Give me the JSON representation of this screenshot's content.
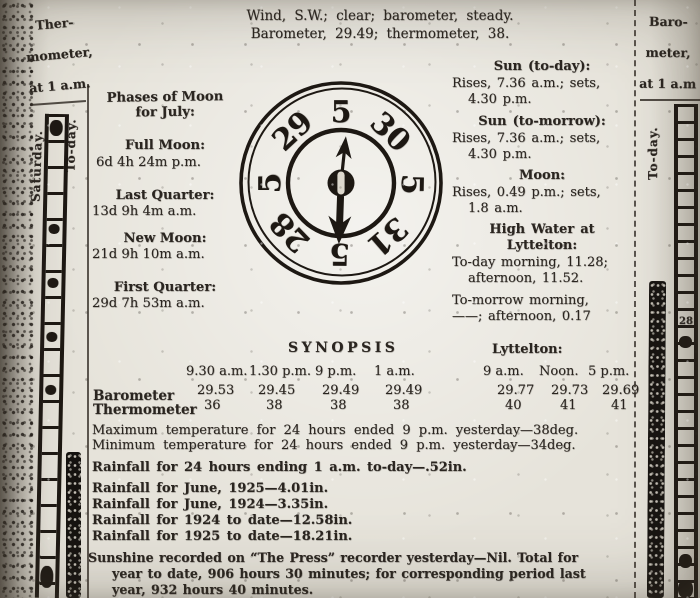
{
  "header": {
    "line1": "Wind, S.W.; clear; barometer, steady.",
    "line2": "Barometer, 29.49; thermometer, 38."
  },
  "left_margin": {
    "title": [
      "Ther-",
      "mometer,",
      "at 1 a.m."
    ],
    "col_labels": [
      "Saturday.",
      "To-day."
    ]
  },
  "right_margin": {
    "title": [
      "Baro-",
      "meter,",
      "at 1 a.m"
    ],
    "col_label": "To-day.",
    "scale_mark": "28"
  },
  "moon": {
    "title": [
      "Phases of Moon",
      "for July:"
    ],
    "entries": [
      {
        "name": "Full Moon:",
        "time": "6d 4h 24m p.m."
      },
      {
        "name": "Last Quarter:",
        "time": "13d 9h 4m a.m."
      },
      {
        "name": "New Moon:",
        "time": "21d 9h 10m a.m."
      },
      {
        "name": "First Quarter:",
        "time": "29d 7h 53m a.m."
      }
    ]
  },
  "dial": {
    "top": "5",
    "ne": "30",
    "e": "5",
    "se": "31",
    "s": "5",
    "sw": "28",
    "w": "5",
    "nw": "29"
  },
  "almanac": {
    "sun_today_title": "Sun (to-day):",
    "sun_today_l1": "Rises, 7.36 a.m.; sets,",
    "sun_today_l2": "4.30 p.m.",
    "sun_tomorrow_title": "Sun (to-morrow):",
    "sun_tomorrow_l1": "Rises, 7.36 a.m.; sets,",
    "sun_tomorrow_l2": "4.30 p.m.",
    "moon_title": "Moon:",
    "moon_l1": "Rises, 0.49 p.m.; sets,",
    "moon_l2": "1.8 a.m.",
    "high_water_t1": "High Water at",
    "high_water_t2": "Lyttelton:",
    "high_water_l1": "To-day morning, 11.28;",
    "high_water_l2": "afternoon, 11.52.",
    "high_water_l3": "To-morrow morning,",
    "high_water_l4": "——; afternoon, 0.17"
  },
  "synopsis": {
    "title": "SYNOPSIS",
    "col_headers": [
      "9.30 a.m.",
      "1.30 p.m.",
      "9 p.m.",
      "1 a.m."
    ],
    "rows": [
      {
        "label": "Barometer",
        "values": [
          "29.53",
          "29.45",
          "29.49",
          "29.49"
        ]
      },
      {
        "label": "Thermometer",
        "values": [
          "36",
          "38",
          "38",
          "38"
        ]
      }
    ]
  },
  "lyttelton": {
    "title": "Lyttelton:",
    "col_headers": [
      "9 a.m.",
      "Noon.",
      "5 p.m."
    ],
    "rows": [
      {
        "values": [
          "29.77",
          "29.73",
          "29.69"
        ]
      },
      {
        "values": [
          "40",
          "41",
          "41"
        ]
      }
    ]
  },
  "temps": {
    "max": "Maximum temperature for 24 hours ended 9 p.m. yesterday—38deg.",
    "min": "Minimum temperature for 24 hours ended 9 p.m. yesterday—34deg."
  },
  "rainfall": {
    "r1": "Rainfall for 24 hours ending 1 a.m. to-day—.52in.",
    "r2": "Rainfall for June, 1925—4.01in.",
    "r3": "Rainfall for June, 1924—3.35in.",
    "r4": "Rainfall for 1924 to date—12.58in.",
    "r5": "Rainfall for 1925 to date—18.21in."
  },
  "sunshine": {
    "l1": "Sunshine recorded on “The Press” recorder yesterday—Nil.  Total for",
    "l2": "year to date, 906 hours 30 minutes; for corresponding period last",
    "l3": "year, 932 hours 40 minutes."
  },
  "colors": {
    "ink": "#1d1813",
    "paper": "#e6e3da"
  }
}
